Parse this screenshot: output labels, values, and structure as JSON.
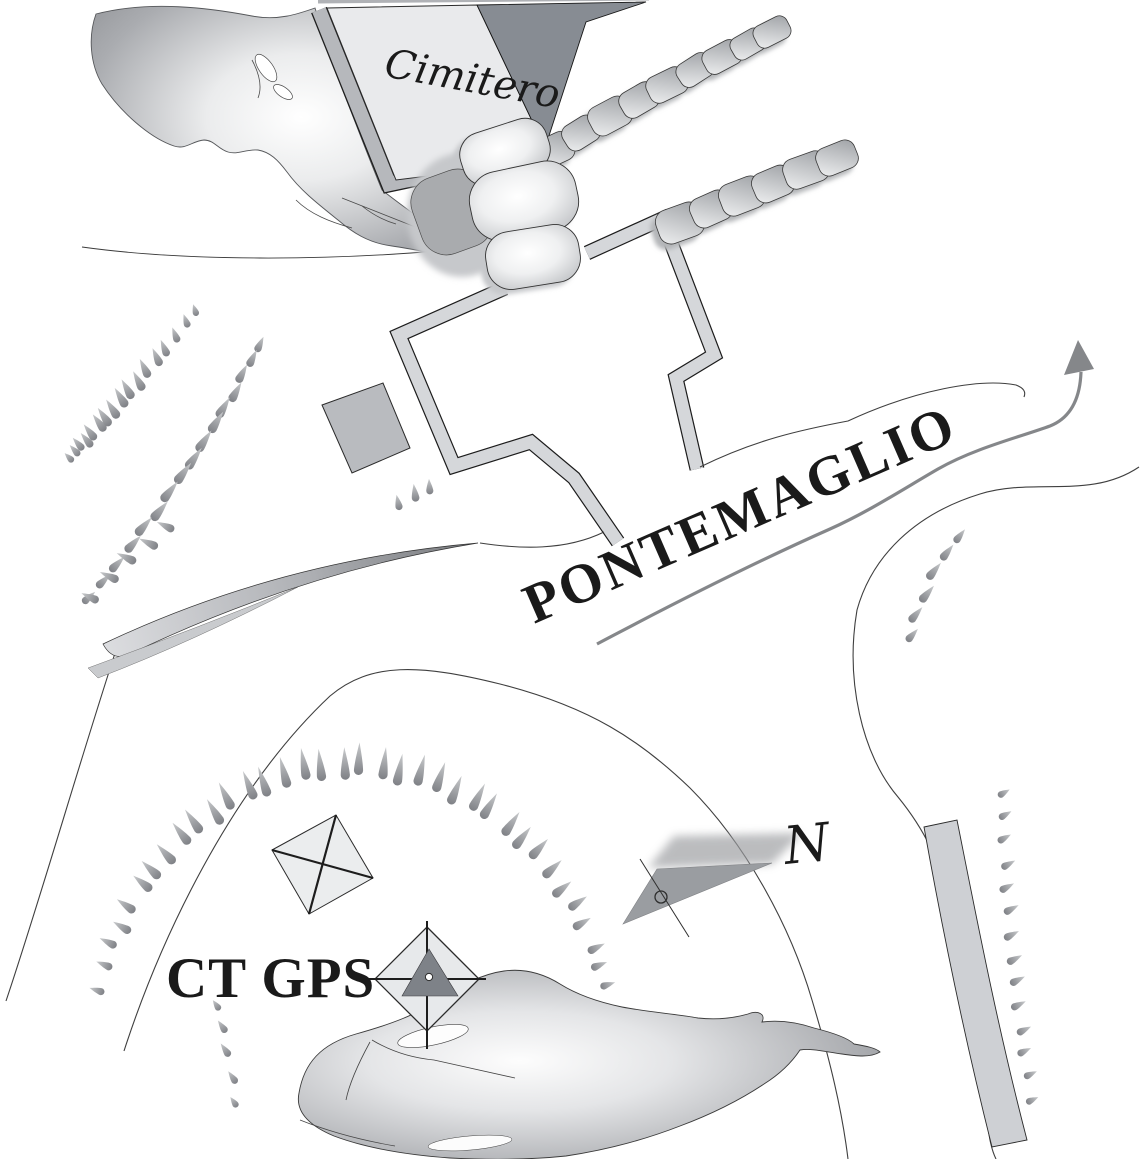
{
  "map": {
    "labels": {
      "cemetery": "Cimitero",
      "place_name": "PONTEMAGLIO",
      "control_point": "CT GPS",
      "north": "N"
    },
    "symbols": [
      "cemetery-building",
      "stone-steps-rows",
      "boundary-walls",
      "small-building-square",
      "ruin-square-with-cross",
      "gps-station-diamond-marker",
      "north-arrow",
      "road-direction-arrow",
      "slope-hachures",
      "rock-outcrops",
      "embankment-sliver",
      "retaining-wall-strip"
    ],
    "colors": {
      "ink": "#2b2b2b",
      "building_light": "#e9eaec",
      "building_dark": "#878c93",
      "wall_band": "#b6b8bc",
      "path_fill": "#d5d7da",
      "square_fill": "#b9bbbf",
      "road_centerline": "#85878a",
      "hachure": "#96989c",
      "rock_edge": "#96989c"
    }
  }
}
